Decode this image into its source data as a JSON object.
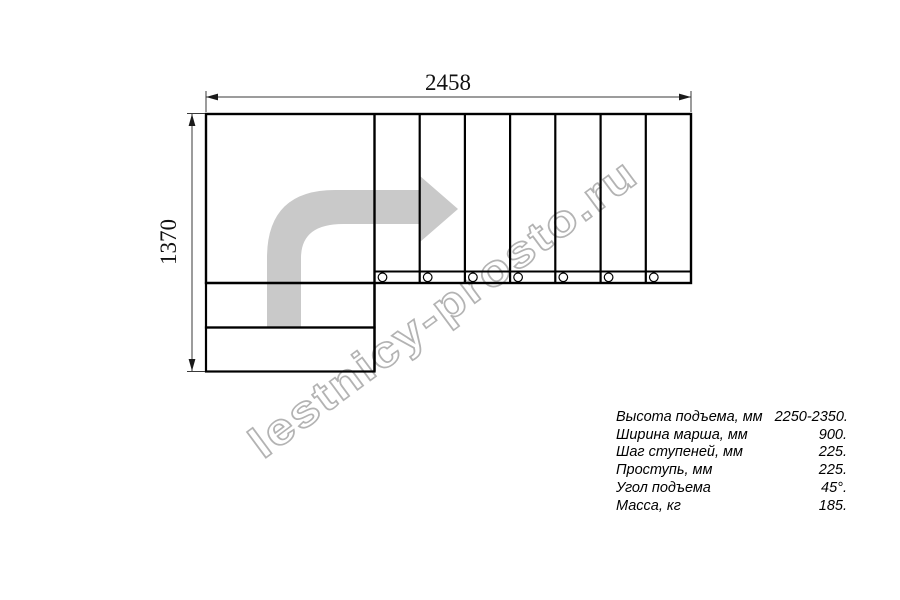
{
  "drawing": {
    "name": "l-shaped-staircase-plan",
    "width_dimension_label": "2458",
    "height_dimension_label": "1370",
    "watermark": "lestnicy-prosto.ru",
    "step_count_straight_flight": 7,
    "step_count_lower": 2
  },
  "specs": {
    "rows": [
      {
        "label": "Высота подъема, мм",
        "value": "2250-2350."
      },
      {
        "label": "Ширина марша, мм",
        "value": "900."
      },
      {
        "label": "Шаг ступеней, мм",
        "value": "225."
      },
      {
        "label": "Проступь, мм",
        "value": "225."
      },
      {
        "label": "Угол подъема",
        "value": "45°."
      },
      {
        "label": "Масса, кг",
        "value": "185."
      }
    ]
  },
  "colors": {
    "background": "#ffffff",
    "outline": "#000000",
    "dimension_line": "#3a3a3a",
    "direction_arrow_fill": "#c9c9c9",
    "watermark_stroke": "#b3b3b3"
  }
}
